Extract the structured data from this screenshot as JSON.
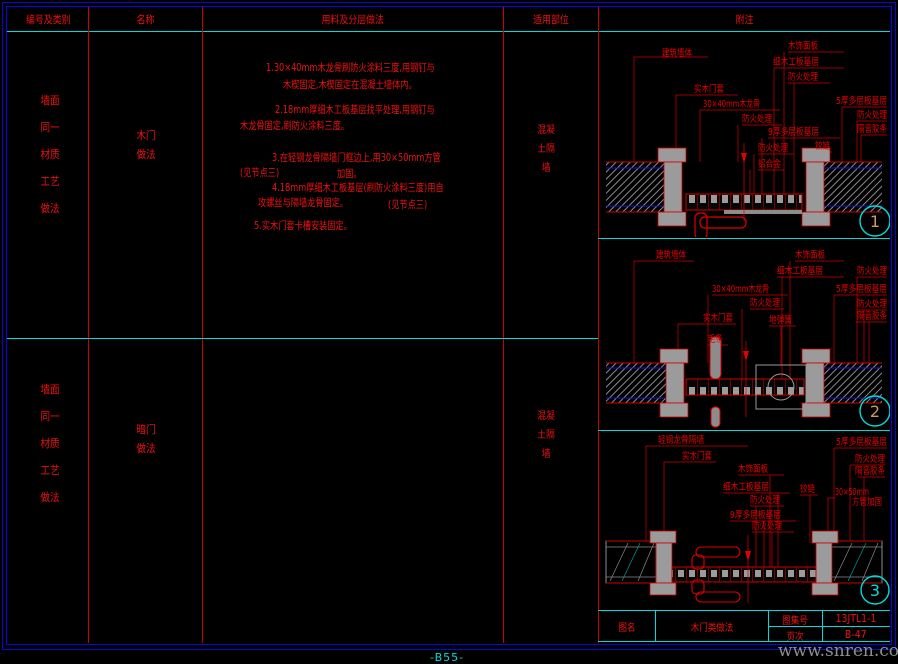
{
  "colors": {
    "red": "#ee1111",
    "cyan": "#00dcdc",
    "blue": "#0808dd",
    "tan": "#cf9a5e",
    "gray": "#8f8f8f"
  },
  "header": {
    "cols": [
      "编号及类别",
      "名称",
      "用料及分层做法",
      "适用部位",
      "附注"
    ]
  },
  "rows": [
    {
      "category_lines": [
        "墙面",
        "同一",
        "材质",
        "工艺",
        "做法"
      ],
      "name_lines": [
        "木门",
        "做法"
      ],
      "location_lines": [
        "混凝",
        "土隔",
        "墙"
      ]
    },
    {
      "category_lines": [
        "墙面",
        "同一",
        "材质",
        "工艺",
        "做法"
      ],
      "name_lines": [
        "暗门",
        "做法"
      ],
      "location_lines": [
        "混凝",
        "土隔",
        "墙"
      ]
    }
  ],
  "notes": {
    "l1a": "1.30×40mm木龙骨刷防火涂料三度,用钢钉与",
    "l1b": "木楔固定,木楔固定在混凝土墙体内。",
    "l2a": "2.18mm厚细木工板基层找平处理,用钢钉与",
    "l2b": "木龙骨固定,刷防火涂料三度。",
    "l3a": "3.在轻钢龙骨隔墙门框边上,用30×50mm方管",
    "l3b_left": "(见节点三)",
    "l3b_right": "加固。",
    "l4a": "4.18mm厚细木工板基层(刷防火涂料三度)用自",
    "l4b_left": "攻螺丝与隔墙龙骨固定。",
    "l4b_right": "(见节点三)",
    "l5": "5.实木门套卡槽安装固定。"
  },
  "details": [
    {
      "number": "1",
      "number_color": "#cf9a5e",
      "labels": [
        "建筑墙体",
        "木饰面板",
        "细木工板基层",
        "防火处理",
        "实木门套",
        "30×40mm木龙骨",
        "防火处理",
        "9厚多层板基层",
        "5厚多层板基层",
        "防火处理",
        "隔音胶条",
        "防火处理",
        "铰链",
        "铝合金"
      ]
    },
    {
      "number": "2",
      "number_color": "#cf9a5e",
      "labels": [
        "建筑墙体",
        "木饰面板",
        "细木工板基层",
        "防火处理",
        "30×40mm木龙骨",
        "5厚多层板基层",
        "防火处理",
        "防火处理",
        "隔音胶条",
        "实木门套",
        "地弹簧",
        "毛条"
      ]
    },
    {
      "number": "3",
      "number_color": "#00dcdc",
      "labels": [
        "轻钢龙骨隔墙",
        "5厚多层板基层",
        "实木门套",
        "防火处理",
        "隔音胶条",
        "木饰面板",
        "细木工板基层",
        "铰链",
        "30×50mm",
        "防火处理",
        "方管加固",
        "9厚多层板基层",
        "防火处理"
      ]
    }
  ],
  "titleblock": {
    "name_label": "图名",
    "name_value": "木门类做法",
    "atlas_label": "图集号",
    "atlas_value": "13JTL1-1",
    "page_label": "页次",
    "page_value": "B-47"
  },
  "footer": {
    "page": "-B55-",
    "watermark": "www.snren.com"
  }
}
